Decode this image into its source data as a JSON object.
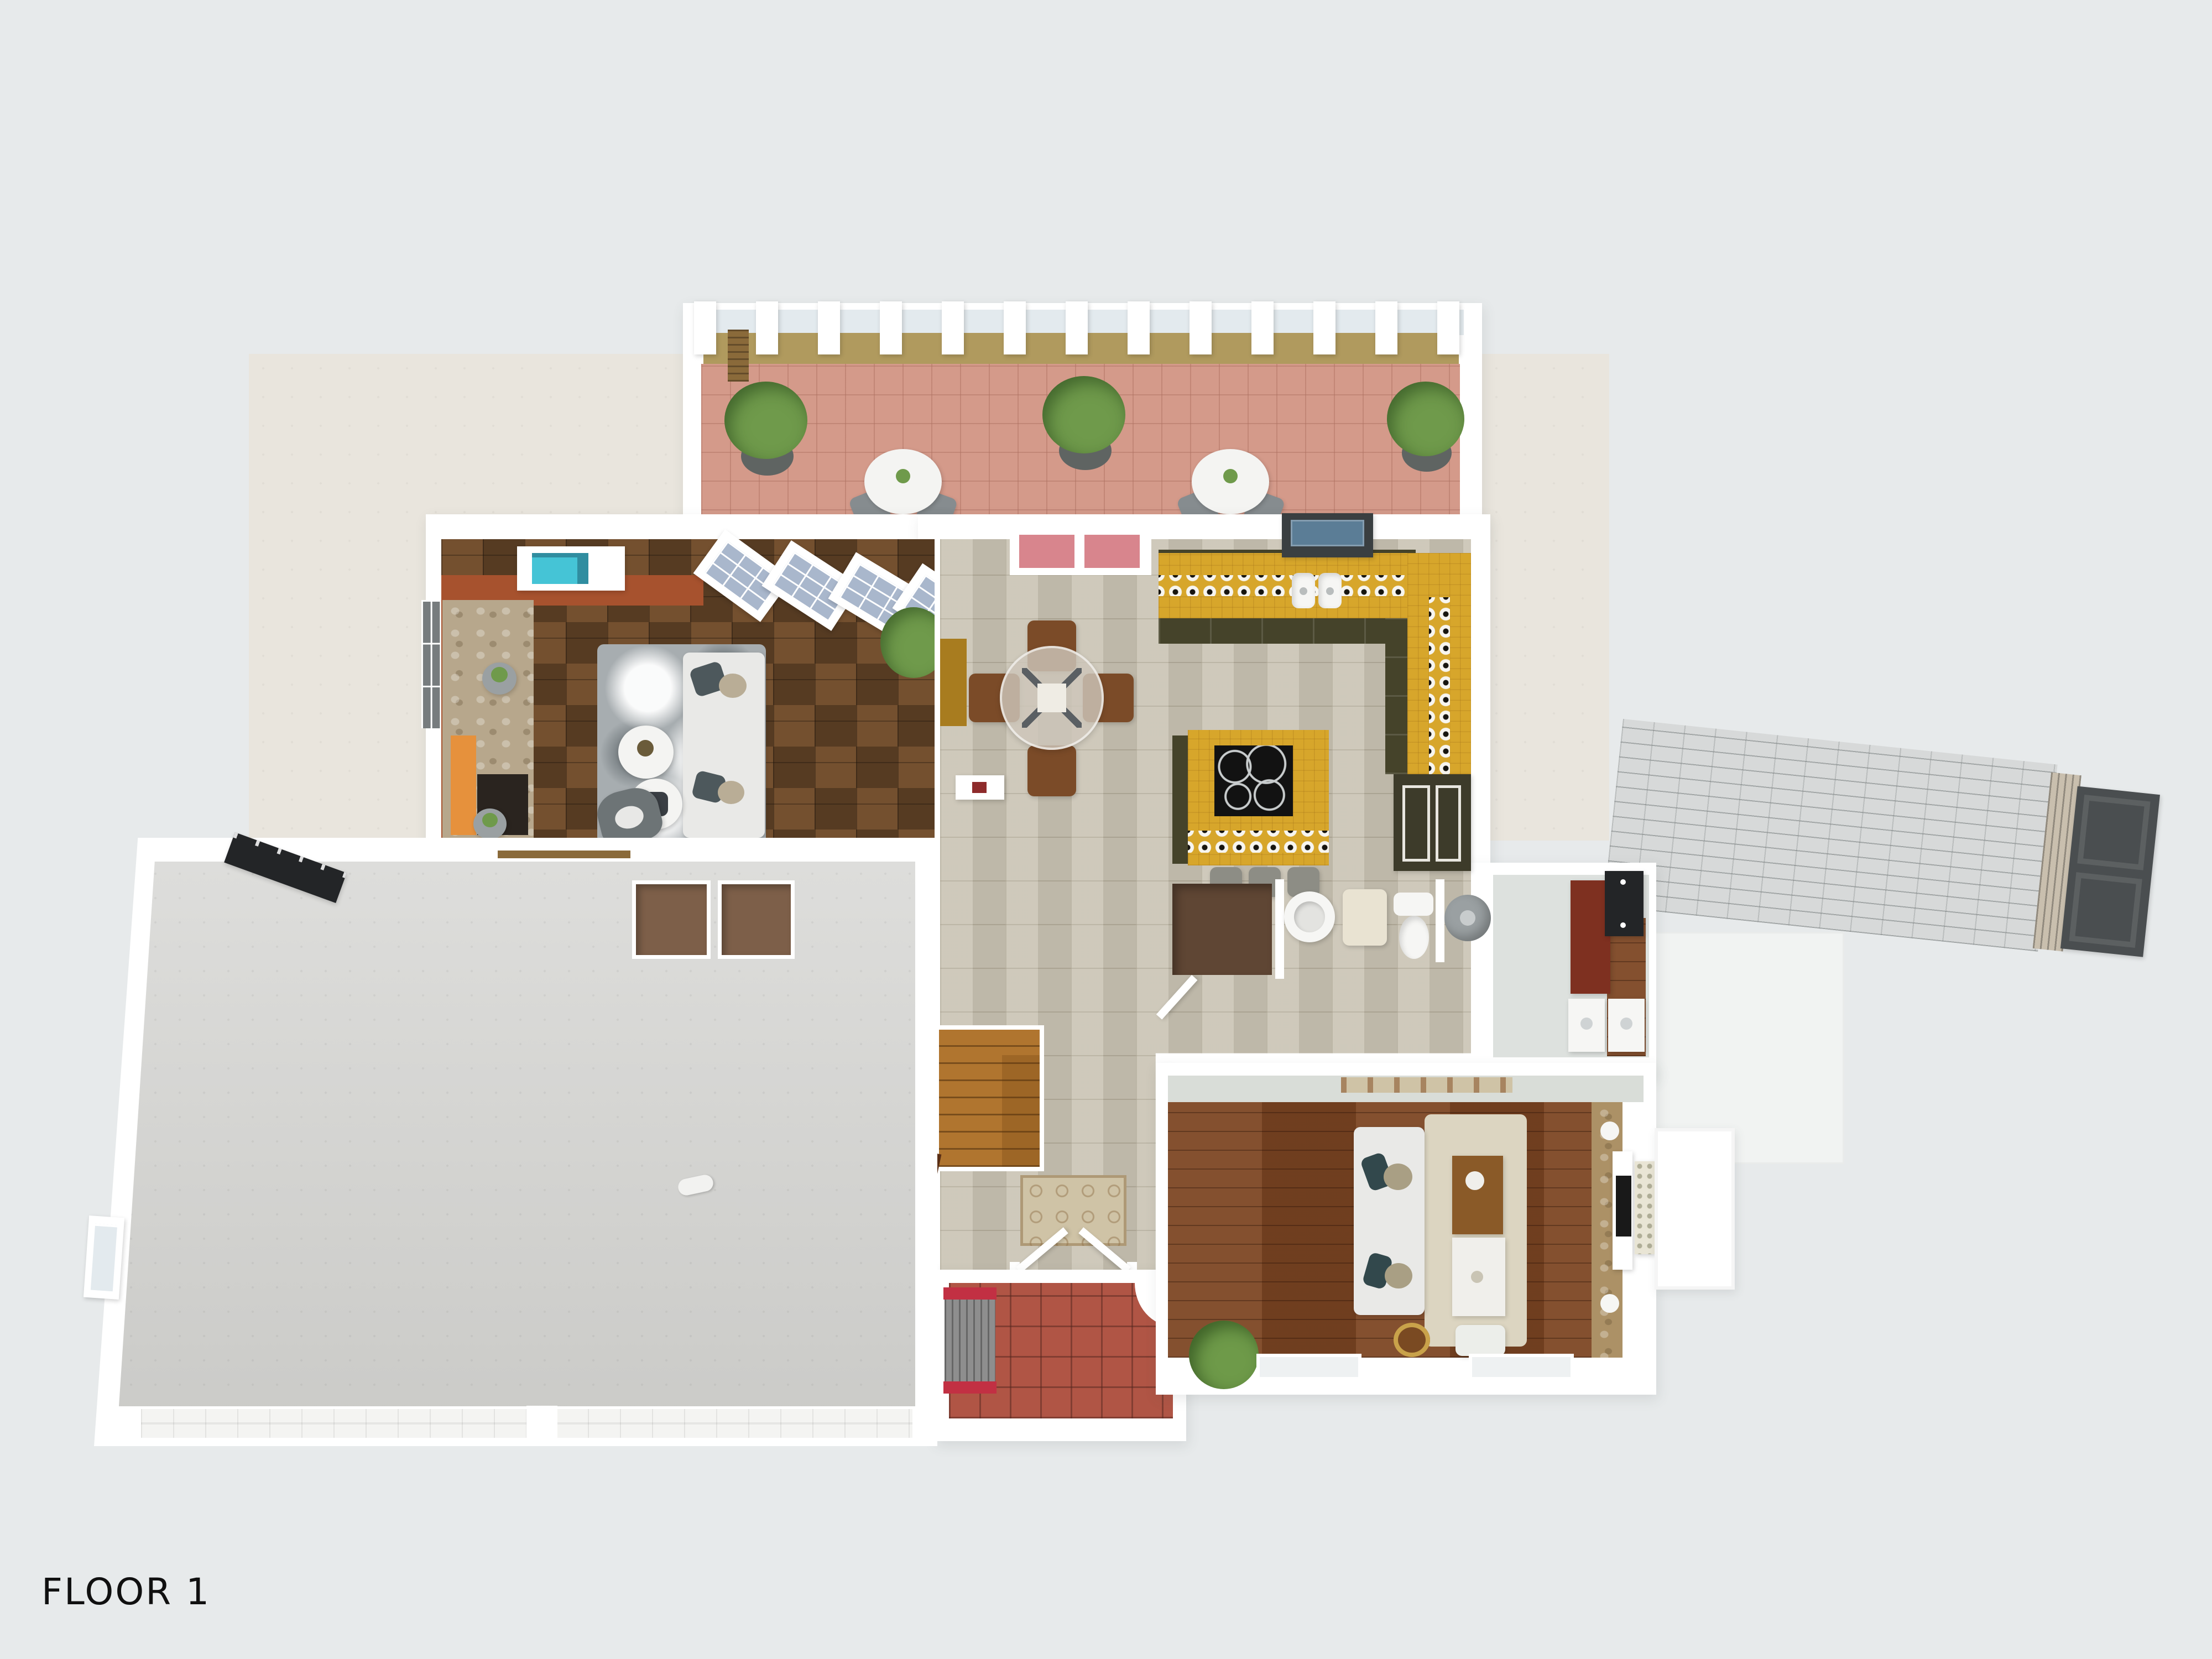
{
  "page": {
    "floor_label": "FLOOR 1"
  },
  "palette": {
    "background": "#e7eaeb",
    "pad": "#e9e5dd",
    "terrace": "#f1f3f2",
    "wall": "#ffffff",
    "hall_pale": "#d9ddd8",
    "mudroom_floor": "#dde1de",
    "patio_tile": "#d49a8a",
    "patio_band": "#b09a5e",
    "patio_glass": "#e3eaee",
    "plant_green": "#6f9a4b",
    "pot_gray": "#5f6462",
    "bistro_white": "#f4f4f2",
    "chair_gray": "#868c8f",
    "wood_trim": "#8a6a3a",
    "living_tile": "#74502f",
    "brick": "#a7522e",
    "fireplace_stone": "#b7a78c",
    "mantel_orange": "#e6913c",
    "firebox": "#2a241f",
    "sofa_white": "#e9e9e7",
    "rug_gray": "#a7adb0",
    "teal_art": "#45c4d6",
    "stone_tile": "#c8c2b2",
    "slider_pink": "#d8858d",
    "mustard_door": "#a87c1f",
    "wood_chair": "#7b4b28",
    "counter_yellow": "#d7a62b",
    "cabinet_olive": "#45432a",
    "cooktop_black": "#121212",
    "stool_gray": "#8d8d85",
    "appliance_dark": "#3d3b2a",
    "window_blue": "#5b7d96",
    "glass_blue": "#a9b7cc",
    "closet_brown": "#5f4634",
    "fixture_white": "#f6f6f4",
    "hamper_beige": "#e9e3d2",
    "heater_gray": "#9aa0a2",
    "stairs_wood": "#b0752f",
    "runner_beige": "#cfc3a6",
    "porch_tile": "#b05545",
    "bench_red": "#c23043",
    "bush_green": "#6e9a49",
    "family_wood": "#7c4522",
    "family_rug": "#dcd5c1",
    "accent_stone": "#ac9166",
    "tv_black": "#191919",
    "art_cream": "#e9e5d5",
    "maroon_cabinet": "#7e3020",
    "garage_floor": "#d2d2cf",
    "niche_brown": "#7d5f49",
    "panel_black": "#232527",
    "walkway_gray": "#d7d9d9",
    "gate_dark": "#4a4e50",
    "pill_white": "#f2f2f0"
  }
}
